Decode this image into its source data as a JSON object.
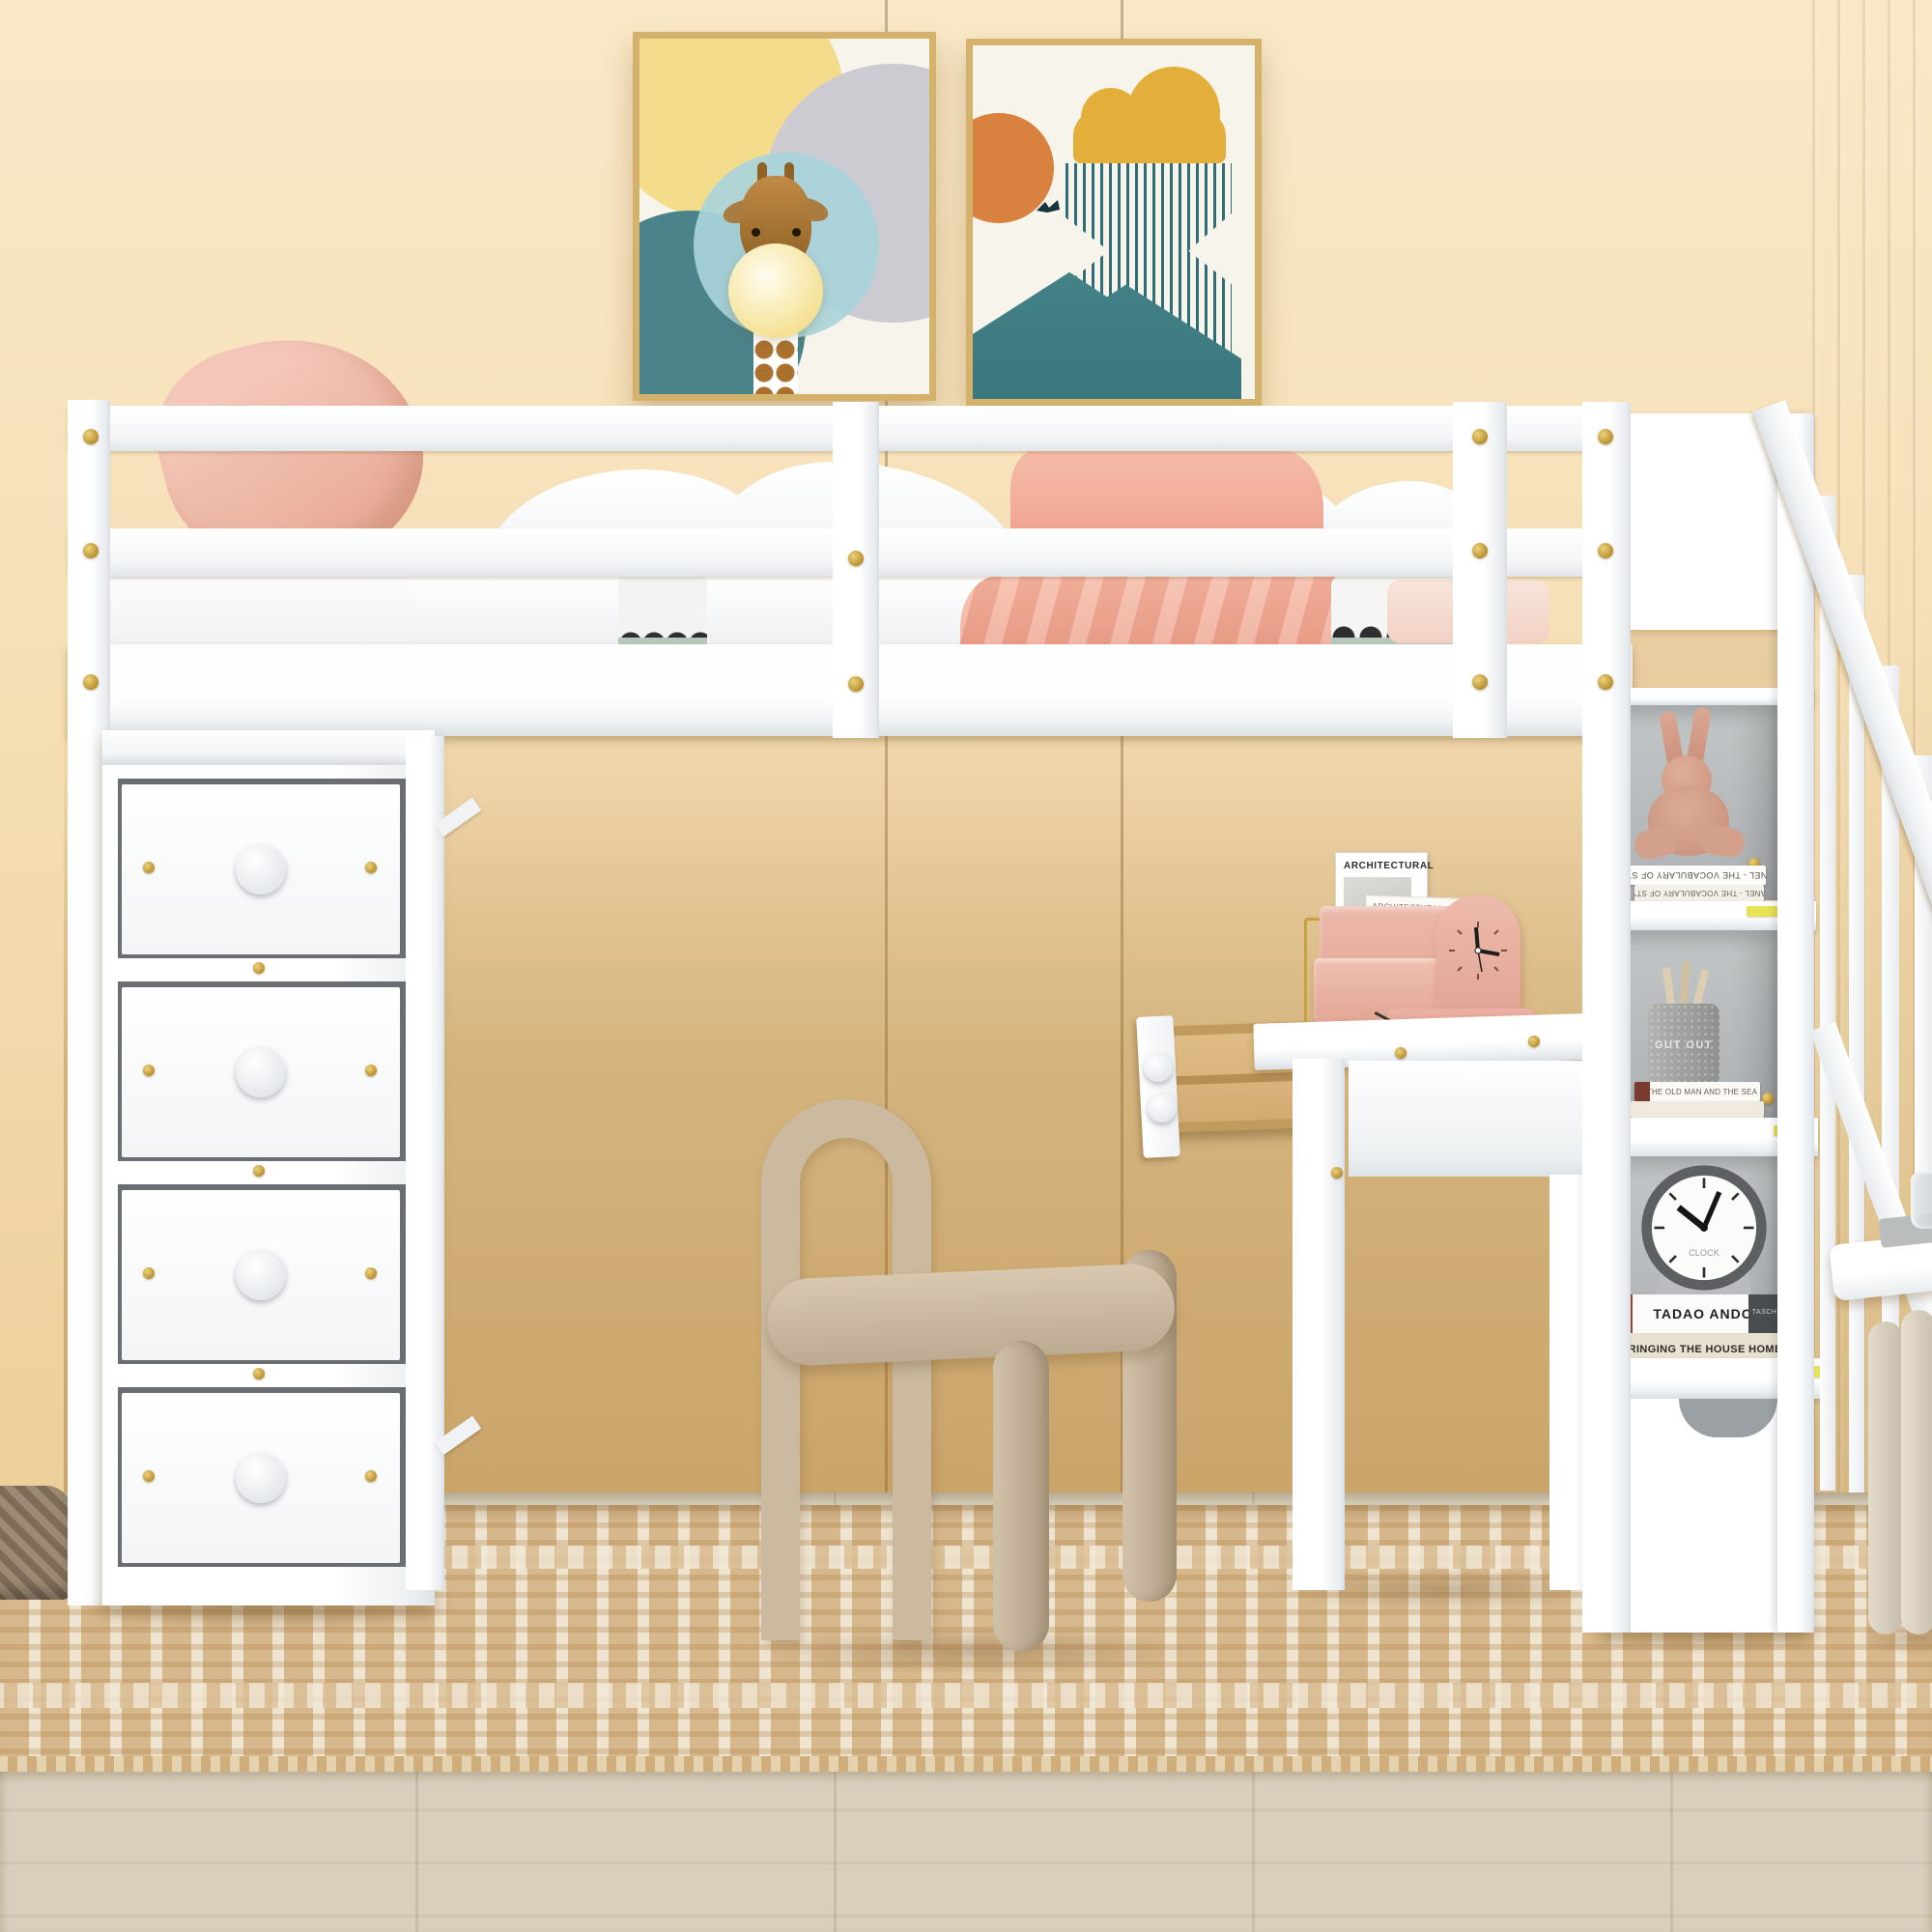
{
  "desk_items": {
    "magazine_front_title": "ARCHITECTURAL",
    "magazine_back_title": "ARCHITECTURAL"
  },
  "shelf_items": {
    "book_spine_top": "CHANEL - THE VOCABULARY OF STYLE",
    "book_spine_bottom": "CHANEL - THE VOCABULARY OF STYLE",
    "pencil_cup_label": "GUT OUT",
    "book_old_man": "THE OLD MAN AND THE SEA",
    "book_tadao": "TADAO ANDO",
    "book_tadao_publisher": "TASCHEN",
    "book_bringing": "BRINGING THE HOUSE HOME",
    "alarm_clock_label": "CLOCK"
  },
  "colors": {
    "wall": "#f7e3bd",
    "wall_deep": "#d3a964",
    "floor": "#d5cdb9",
    "rug": "#d7b88c",
    "rug_cream": "#efe4cf",
    "furniture_white": "#ffffff",
    "panel_gray": "#b9bdbf",
    "gold": "#c9a23e",
    "frame_gold": "#d4b26b",
    "pink": "#f0c0b2",
    "salmon": "#f2ad99",
    "chair_beige": "#c9b79d",
    "teal": "#45858b",
    "teal_deep": "#2f6d77",
    "light_blue": "#aad4da",
    "butter_yellow": "#f3dd8d",
    "circle_gray": "#cbcbd1",
    "orange": "#d9813f",
    "cloud_gold": "#e3ae3a"
  }
}
